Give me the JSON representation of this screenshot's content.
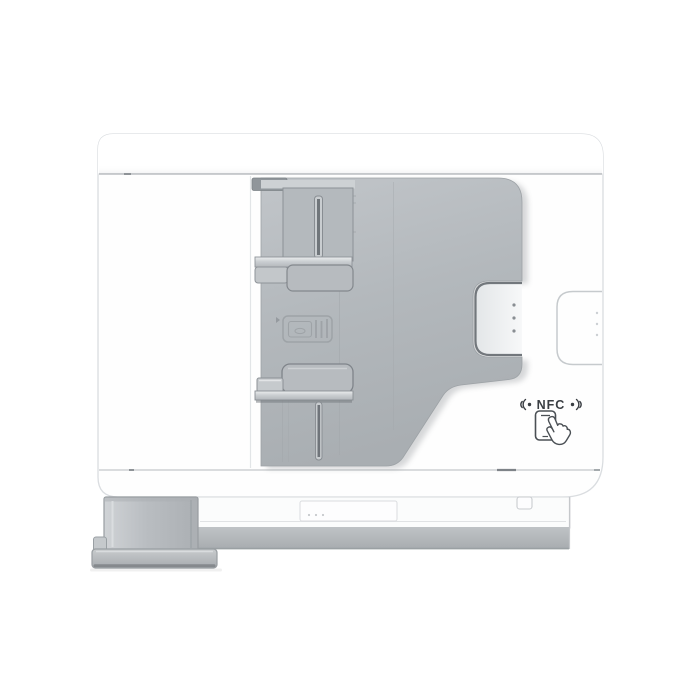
{
  "image": {
    "kind": "product-photo",
    "subject": "Multifunction printer, side view, ADF paper tray and guides extended",
    "nfc_label": "NFC",
    "icons": [
      {
        "name": "nfc-wave-left-icon",
        "meaning": "NFC radio waves left of label"
      },
      {
        "name": "nfc-wave-right-icon",
        "meaning": "NFC radio waves right of label"
      },
      {
        "name": "phone-tap-icon",
        "meaning": "tap smartphone on NFC area"
      },
      {
        "name": "cassette-emblem",
        "meaning": "embossed paper-cassette marking on tray"
      }
    ],
    "colors": {
      "background": "#ffffff",
      "body": "#fdfdfe",
      "adf_gray": "#b3b8bc",
      "adf_dark_edge": "#8d9297",
      "base_band": "#b5b9bc",
      "tray_gray": "#bcc0c4",
      "seam": "#a9aeb2",
      "nfc_text": "#3a3e43"
    }
  }
}
